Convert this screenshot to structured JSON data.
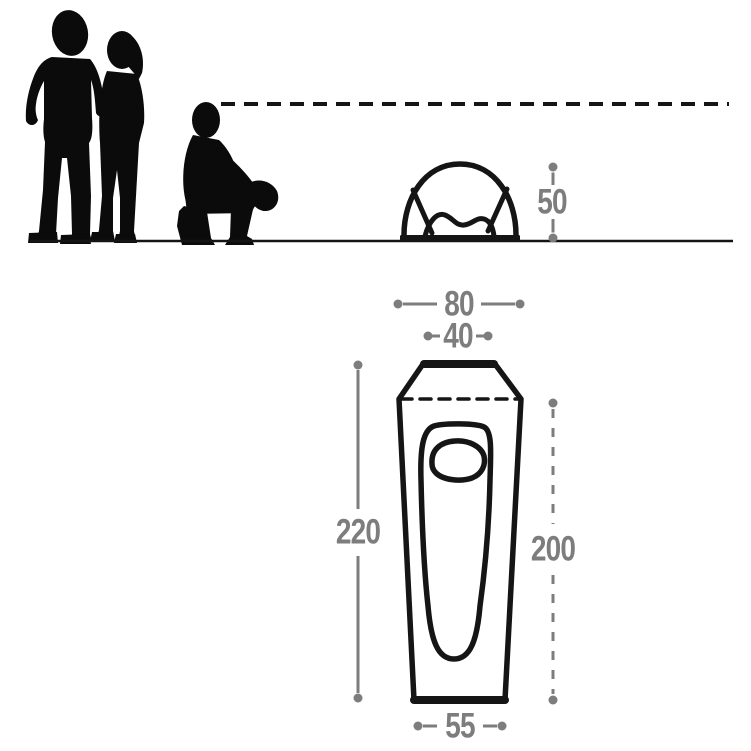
{
  "colors": {
    "figure": "#0b0b0b",
    "outline": "#151515",
    "dimension": "#7d7d7d",
    "background": "#ffffff"
  },
  "side_view": {
    "height_label": "50"
  },
  "top_view": {
    "top_width_label": "80",
    "peak_width_label": "40",
    "outer_length_label": "220",
    "inner_length_label": "200",
    "bottom_width_label": "55"
  }
}
